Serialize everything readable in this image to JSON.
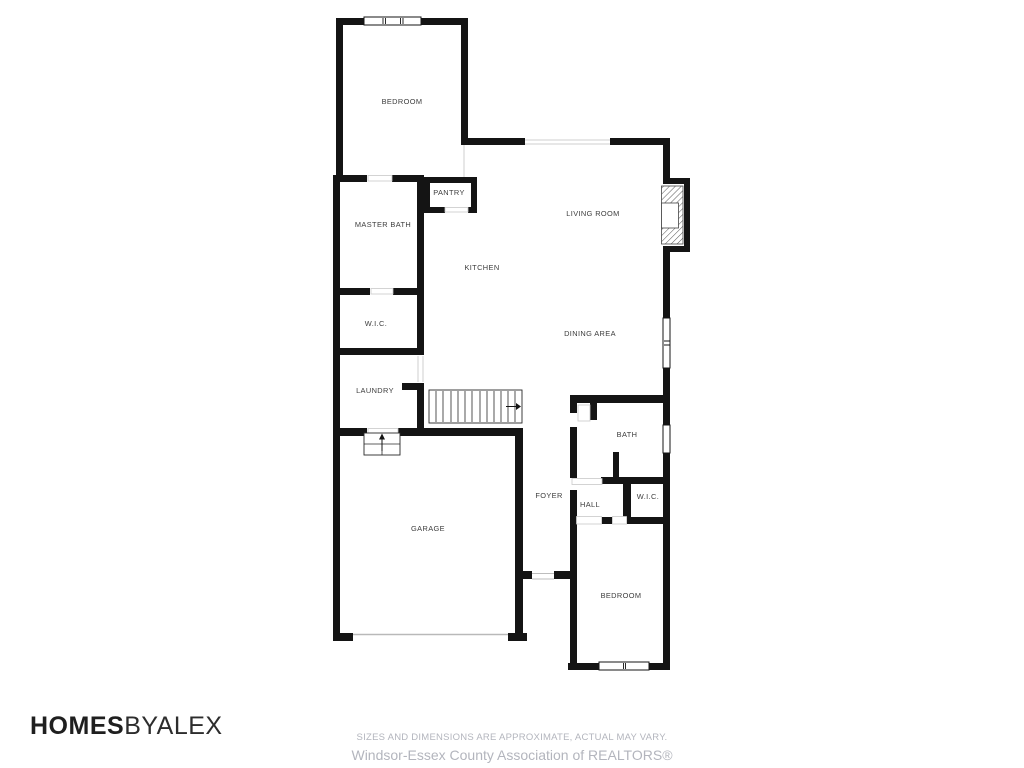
{
  "floorplan": {
    "rooms": {
      "bedroom_top": "BEDROOM",
      "master_bath": "MASTER BATH",
      "wic_top": "W.I.C.",
      "laundry": "LAUNDRY",
      "pantry": "PANTRY",
      "kitchen": "KITCHEN",
      "living_room": "LIVING ROOM",
      "dining_area": "DINING AREA",
      "garage": "GARAGE",
      "foyer": "FOYER",
      "hall": "HALL",
      "bath": "BATH",
      "wic_bottom": "W.I.C.",
      "bedroom_bottom": "BEDROOM"
    },
    "colors": {
      "wall": "#141414",
      "label": "#3d3d3d",
      "thin_line": "#c9c9c9",
      "background": "#ffffff"
    }
  },
  "footer": {
    "logo_bold": "HOMES",
    "logo_light": "BYALEX",
    "disclaimer": "SIZES AND DIMENSIONS ARE APPROXIMATE, ACTUAL MAY VARY.",
    "attribution": "Windsor-Essex County Association of REALTORS®"
  }
}
